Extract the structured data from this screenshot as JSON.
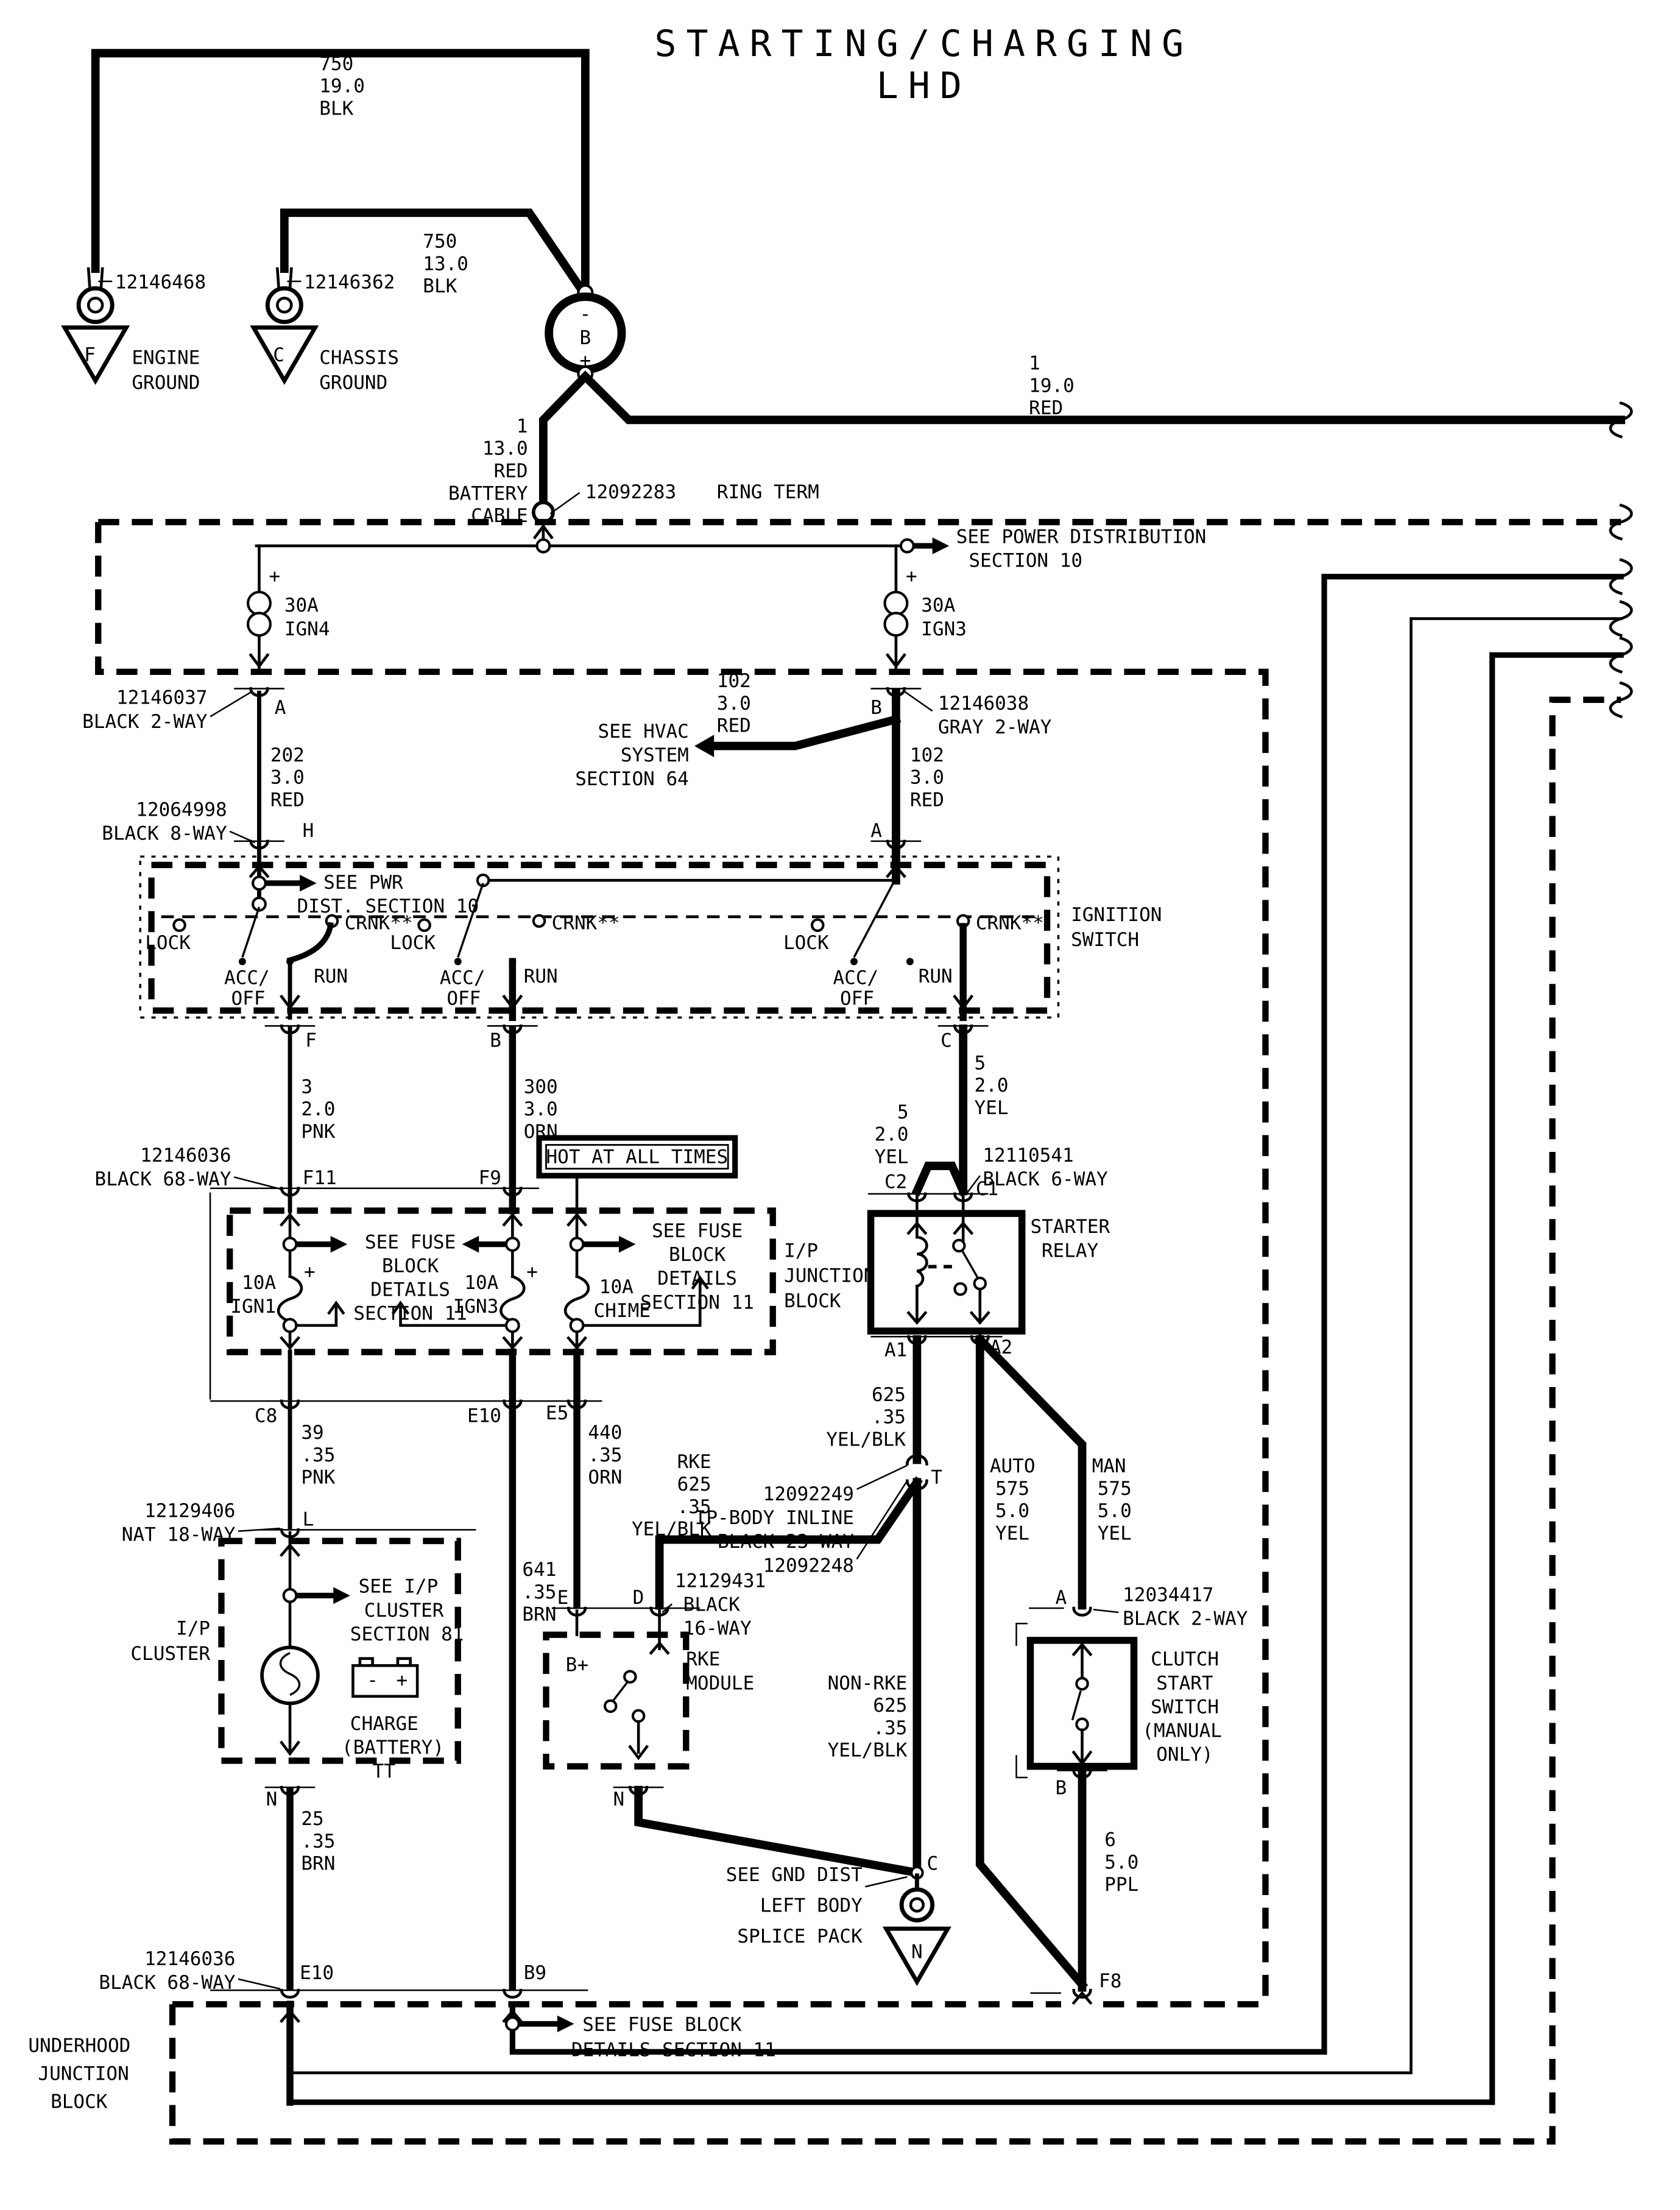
{
  "title": {
    "l1": "STARTING/CHARGING",
    "l2": "LHD"
  },
  "grounds": {
    "engine": {
      "part": "12146468",
      "n1": "ENGINE",
      "n2": "GROUND",
      "pin": "F"
    },
    "chassis": {
      "part": "12146362",
      "n1": "CHASSIS",
      "n2": "GROUND",
      "pin": "C"
    },
    "left_body": {
      "see": [
        "SEE GND DIST",
        "LEFT BODY",
        "SPLICE PACK"
      ],
      "pin": "C",
      "tri": "N"
    }
  },
  "battery": {
    "b": "B",
    "minus": "-",
    "plus": "+"
  },
  "ring_term": {
    "part": "12092283",
    "name": "RING TERM"
  },
  "power_dist": {
    "see1": "SEE POWER DISTRIBUTION",
    "see2": "SECTION 10",
    "plus": "+",
    "fuse1": [
      "30A",
      "IGN4"
    ],
    "fuse2": [
      "30A",
      "IGN3"
    ]
  },
  "hvac": [
    "SEE HVAC",
    "SYSTEM",
    "SECTION 64"
  ],
  "hot": "HOT AT ALL TIMES",
  "wire_labels": {
    "blk750_19": [
      "750",
      "19.0",
      "BLK"
    ],
    "blk750_13": [
      "750",
      "13.0",
      "BLK"
    ],
    "red1_19": [
      "1",
      "19.0",
      "RED"
    ],
    "red1_13": [
      "1",
      "13.0",
      "RED",
      "BATTERY",
      "CABLE"
    ],
    "red202": [
      "202",
      "3.0",
      "RED"
    ],
    "red102a": [
      "102",
      "3.0",
      "RED"
    ],
    "red102b": [
      "102",
      "3.0",
      "RED"
    ],
    "pnk3": [
      "3",
      "2.0",
      "PNK"
    ],
    "orn300": [
      "300",
      "3.0",
      "ORN"
    ],
    "yel5a": [
      "5",
      "2.0",
      "YEL"
    ],
    "yel5b": [
      "5",
      "2.0",
      "YEL"
    ],
    "pnk39": [
      "39",
      ".35",
      "PNK"
    ],
    "brn641": [
      "641",
      ".35",
      "BRN"
    ],
    "orn440": [
      "440",
      ".35",
      "ORN"
    ],
    "rke625": [
      "RKE",
      "625",
      ".35",
      "YEL/BLK"
    ],
    "yelblk625": [
      "625",
      ".35",
      "YEL/BLK"
    ],
    "nonrke625": [
      "NON-RKE",
      "625",
      ".35",
      "YEL/BLK"
    ],
    "auto575": [
      "AUTO",
      "575",
      "5.0",
      "YEL"
    ],
    "man575": [
      "MAN",
      "575",
      "5.0",
      "YEL"
    ],
    "brn25": [
      "25",
      ".35",
      "BRN"
    ],
    "ppl6": [
      "6",
      "5.0",
      "PPL"
    ]
  },
  "connectors": {
    "c12146037": [
      "12146037",
      "BLACK 2-WAY"
    ],
    "c12146038": [
      "12146038",
      "GRAY 2-WAY"
    ],
    "c12064998": [
      "12064998",
      "BLACK 8-WAY"
    ],
    "c12146036": [
      "12146036",
      "BLACK 68-WAY"
    ],
    "c12110541": [
      "12110541",
      "BLACK 6-WAY"
    ],
    "inline": [
      "12092249",
      "IP-BODY INLINE",
      "BLACK 23-WAY",
      "12092248"
    ],
    "c12129406": [
      "12129406",
      "NAT 18-WAY"
    ],
    "c12129431": [
      "12129431",
      "BLACK",
      "16-WAY"
    ],
    "c12034417": [
      "12034417",
      "BLACK 2-WAY"
    ],
    "c12146036b": [
      "12146036",
      "BLACK 68-WAY"
    ]
  },
  "pins": {
    "A": "A",
    "B": "B",
    "H": "H",
    "A8": "A",
    "F": "F",
    "Bi": "B",
    "C": "C",
    "F11": "F11",
    "F9": "F9",
    "C2": "C2",
    "C1": "C1",
    "A1": "A1",
    "A2": "A2",
    "C8": "C8",
    "E10": "E10",
    "E5": "E5",
    "L": "L",
    "T": "T",
    "E": "E",
    "D": "D",
    "N": "N",
    "Nrke": "N",
    "Acl": "A",
    "Bcl": "B",
    "E10b": "E10",
    "B9": "B9",
    "F8": "F8"
  },
  "ignition": {
    "label": [
      "IGNITION",
      "SWITCH"
    ],
    "see": [
      "SEE PWR",
      "DIST. SECTION 10"
    ],
    "lock": "LOCK",
    "crnk": "CRNK**",
    "acc": "ACC/",
    "off": "OFF",
    "run": "RUN"
  },
  "relay": {
    "label": [
      "STARTER",
      "RELAY"
    ]
  },
  "fuse_block": {
    "see_left": [
      "SEE FUSE",
      "BLOCK",
      "DETAILS",
      "SECTION 11"
    ],
    "see_right": [
      "SEE FUSE",
      "BLOCK",
      "DETAILS",
      "SECTION 11"
    ],
    "f1": [
      "10A",
      "IGN1"
    ],
    "f2": [
      "10A",
      "IGN3"
    ],
    "f3": [
      "10A",
      "CHIME"
    ],
    "plus": "+",
    "label": [
      "I/P",
      "JUNCTION",
      "BLOCK"
    ]
  },
  "cluster": {
    "label": [
      "I/P",
      "CLUSTER"
    ],
    "see": [
      "SEE I/P",
      "CLUSTER",
      "SECTION 81"
    ],
    "charge": [
      "CHARGE",
      "(BATTERY)",
      "TT"
    ],
    "minus": "-",
    "plus": "+"
  },
  "rke": {
    "label": [
      "RKE",
      "MODULE"
    ],
    "bplus": "B+"
  },
  "clutch": {
    "label": [
      "CLUTCH",
      "START",
      "SWITCH",
      "(MANUAL",
      "ONLY)"
    ]
  },
  "bottom": {
    "see": [
      "SEE FUSE BLOCK",
      "DETAILS SECTION 11"
    ],
    "label": [
      "UNDERHOOD",
      "JUNCTION",
      "BLOCK"
    ]
  }
}
